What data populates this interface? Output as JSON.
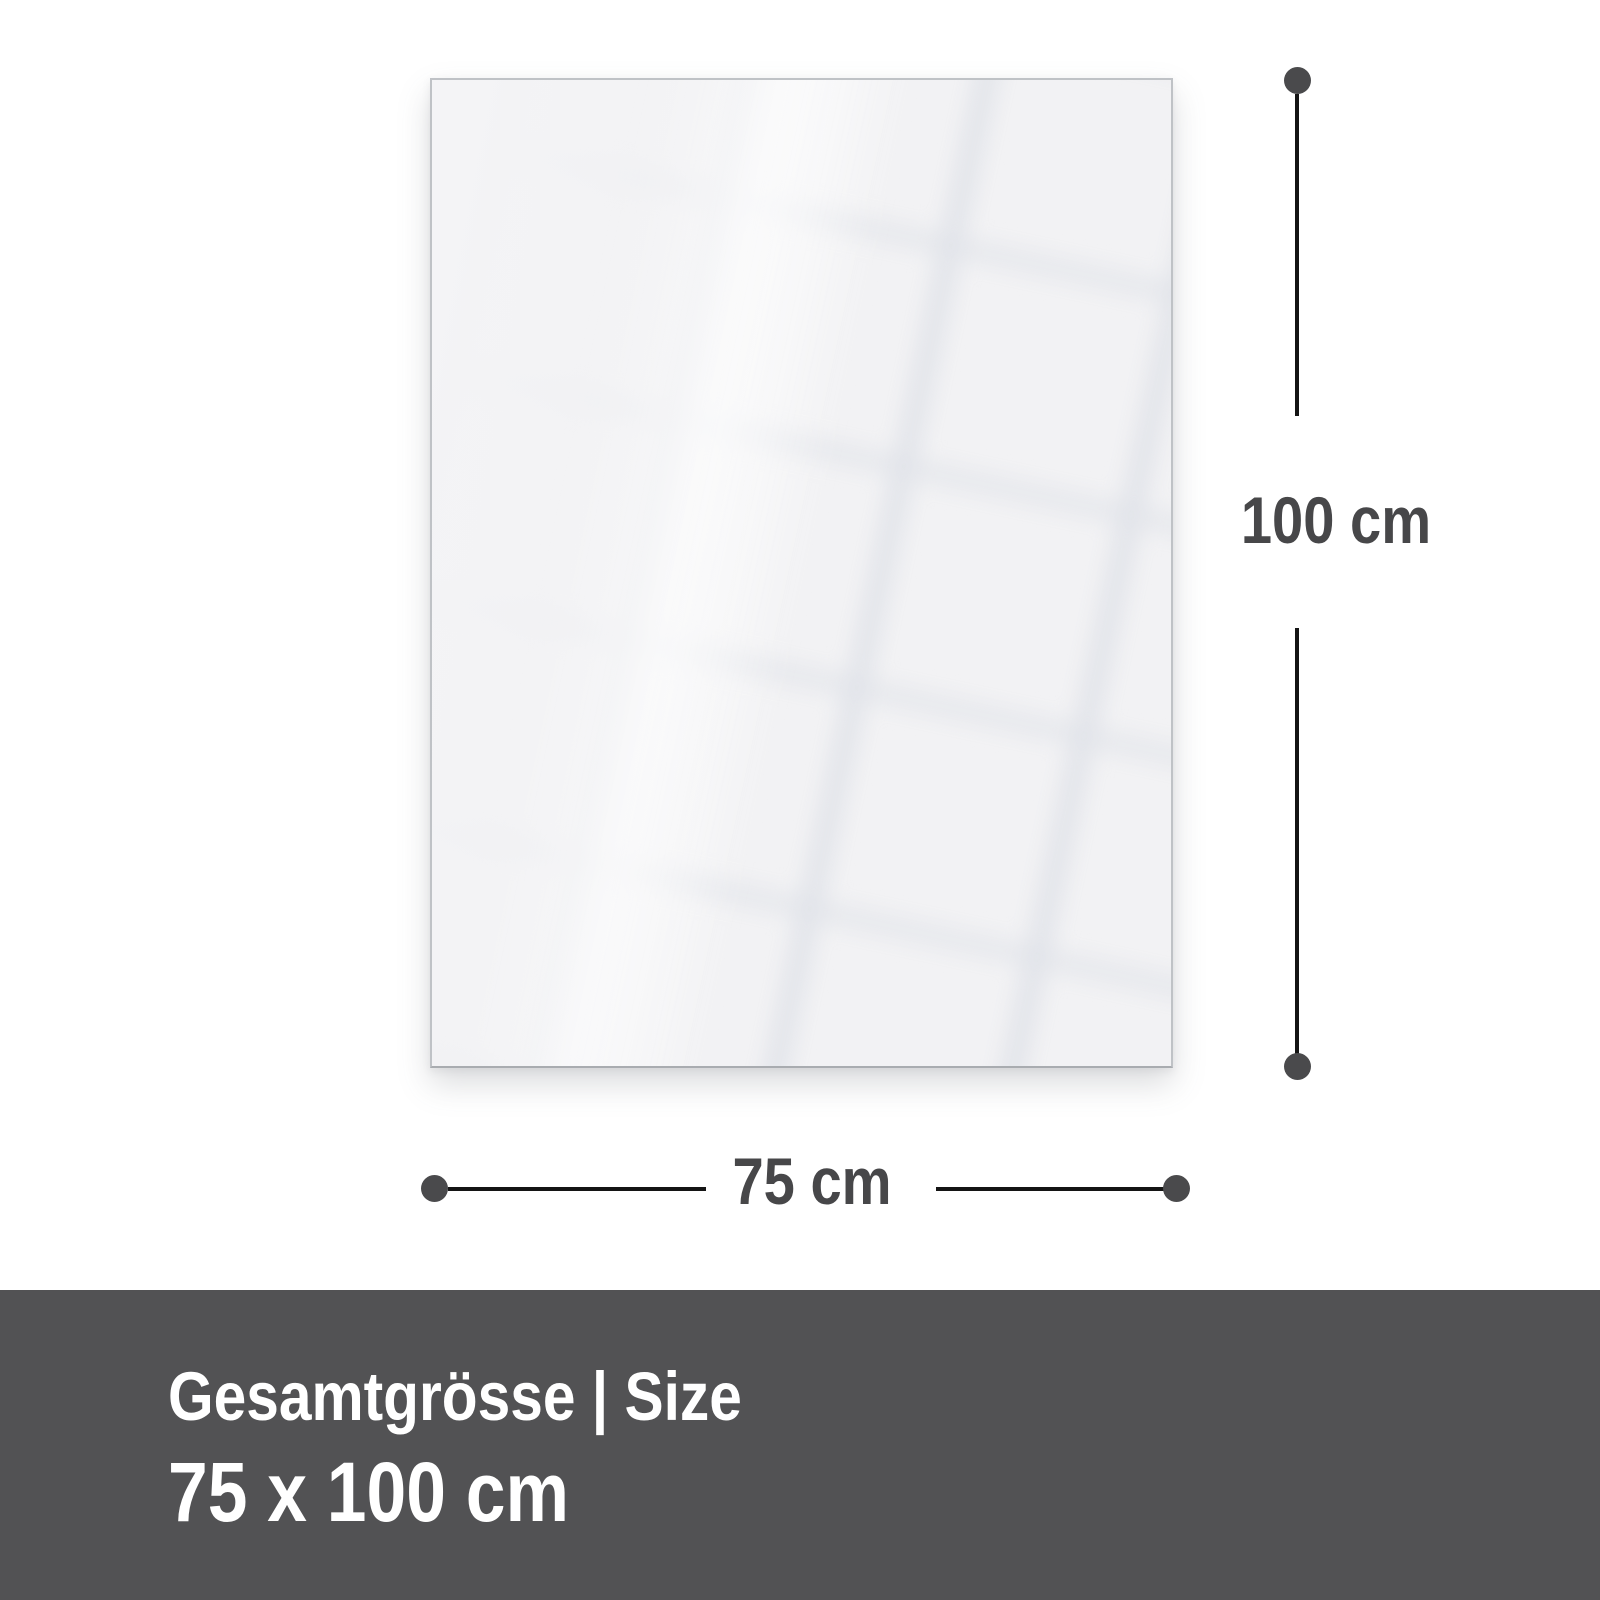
{
  "page": {
    "background_color": "#ffffff"
  },
  "diagram": {
    "panel": {
      "description": "glossy glass panel front view with faint tile reflection",
      "fill_color": "#f2f2f4",
      "border_color": "#bfc2c6"
    },
    "dimension_style": {
      "line_color": "#141414",
      "dot_color": "#4a4a4c",
      "label_color": "#474749"
    },
    "height_dimension": {
      "label": "100 cm"
    },
    "width_dimension": {
      "label": "75 cm"
    }
  },
  "footer": {
    "background_color": "#525254",
    "text_color": "#ffffff",
    "title": "Gesamtgrösse | Size",
    "size_value": "75 x 100 cm"
  }
}
